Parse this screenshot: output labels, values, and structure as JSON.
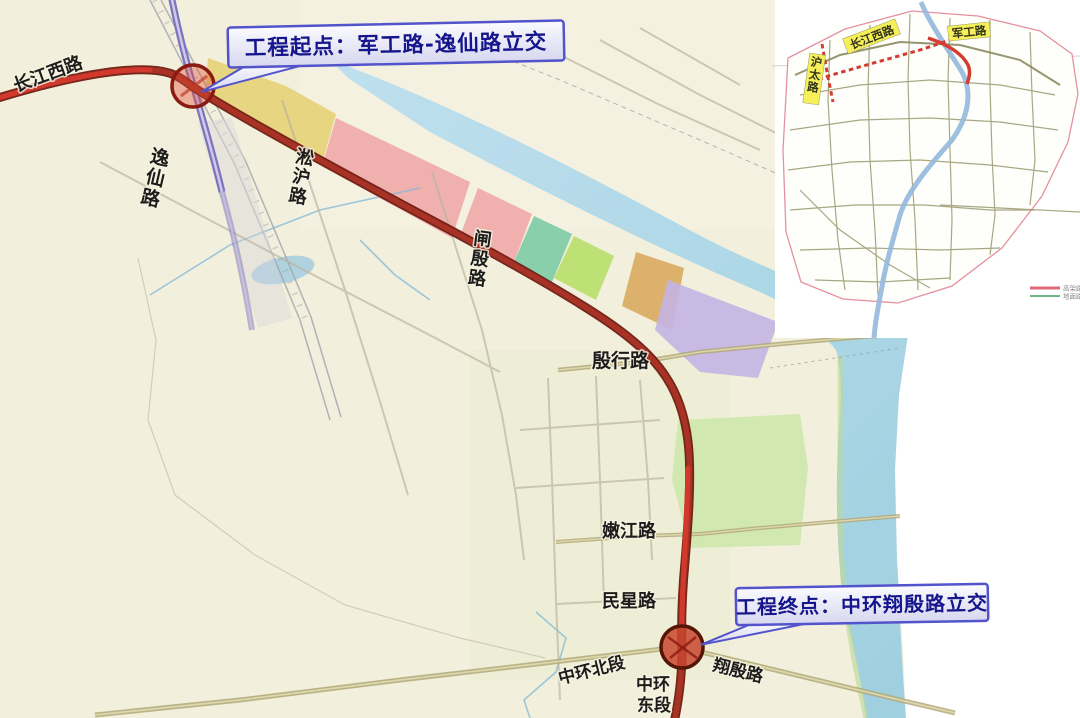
{
  "callouts": {
    "start": "工程起点：军工路-逸仙路立交",
    "end": "工程终点：中环翔殷路立交"
  },
  "main_map": {
    "road_labels": {
      "changjiang_west_road": "长江西路",
      "yixian_road": "逸仙路",
      "songhu_road": "淞沪路",
      "zhayin_road": "闸殷路",
      "yinhang_road": "殷行路",
      "nenjiang_road": "嫩江路",
      "minxing_road": "民星路",
      "middle_ring_north": "中环北段",
      "middle_ring_east_line1": "中环",
      "middle_ring_east_line2": "东段",
      "xiangyin_road": "翔殷路"
    }
  },
  "inset_map": {
    "road_labels": {
      "changjiang_west_road": "长江西路",
      "jungong_road": "军工路",
      "hutai_road": "沪太路"
    },
    "legend": [
      {
        "label": "高架路",
        "color": "#e06a78"
      },
      {
        "label": "地面路",
        "color": "#3f9e5f"
      }
    ]
  },
  "colors": {
    "route_red": "#a83226",
    "route_red_bright": "#d2392c",
    "elevated_purple": "#7d74bc",
    "river_blue": "#aed6e6",
    "land_cream": "#f2efdc",
    "callout_border": "#5353cc",
    "callout_text": "#15158c",
    "interchange_marker": "#8b1a10",
    "parcel_yellow": "#e6d27a",
    "parcel_pink": "#f0a8a8",
    "parcel_teal": "#7ecba6",
    "parcel_green": "#b8e06a",
    "parcel_tan": "#d8a85c",
    "parcel_purple": "#c4b4e4",
    "parcel_park_green": "#cfe8ae",
    "inset_label_bg": "#f5ef5a"
  }
}
